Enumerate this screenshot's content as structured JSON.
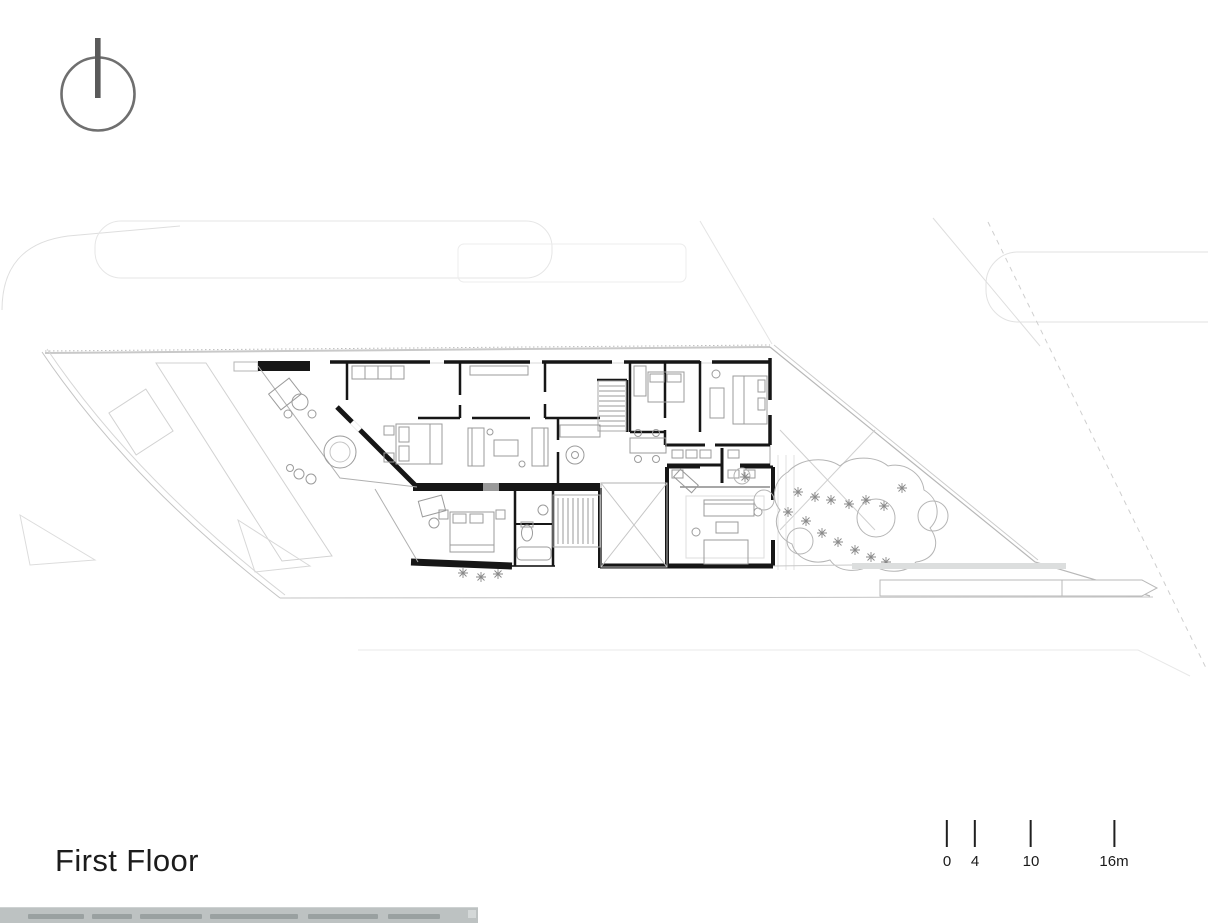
{
  "sheet": {
    "title": "First Floor",
    "background": "#ffffff"
  },
  "north_arrow": {
    "symbol": "circle-with-vertical-bar",
    "color": "#6f6f6f"
  },
  "scale_bar": {
    "unit_suffix": "m",
    "ticks": [
      {
        "label": "0"
      },
      {
        "label": "4"
      },
      {
        "label": "10"
      },
      {
        "label": "16m"
      }
    ]
  },
  "drawing": {
    "kind": "architectural-floor-plan",
    "floor_label": "First Floor"
  },
  "colors": {
    "walls": "#161616",
    "site_lines": "#c9c9c9",
    "furniture_lines": "#9b9b9b",
    "caption_bar": "#bdc2c2"
  }
}
